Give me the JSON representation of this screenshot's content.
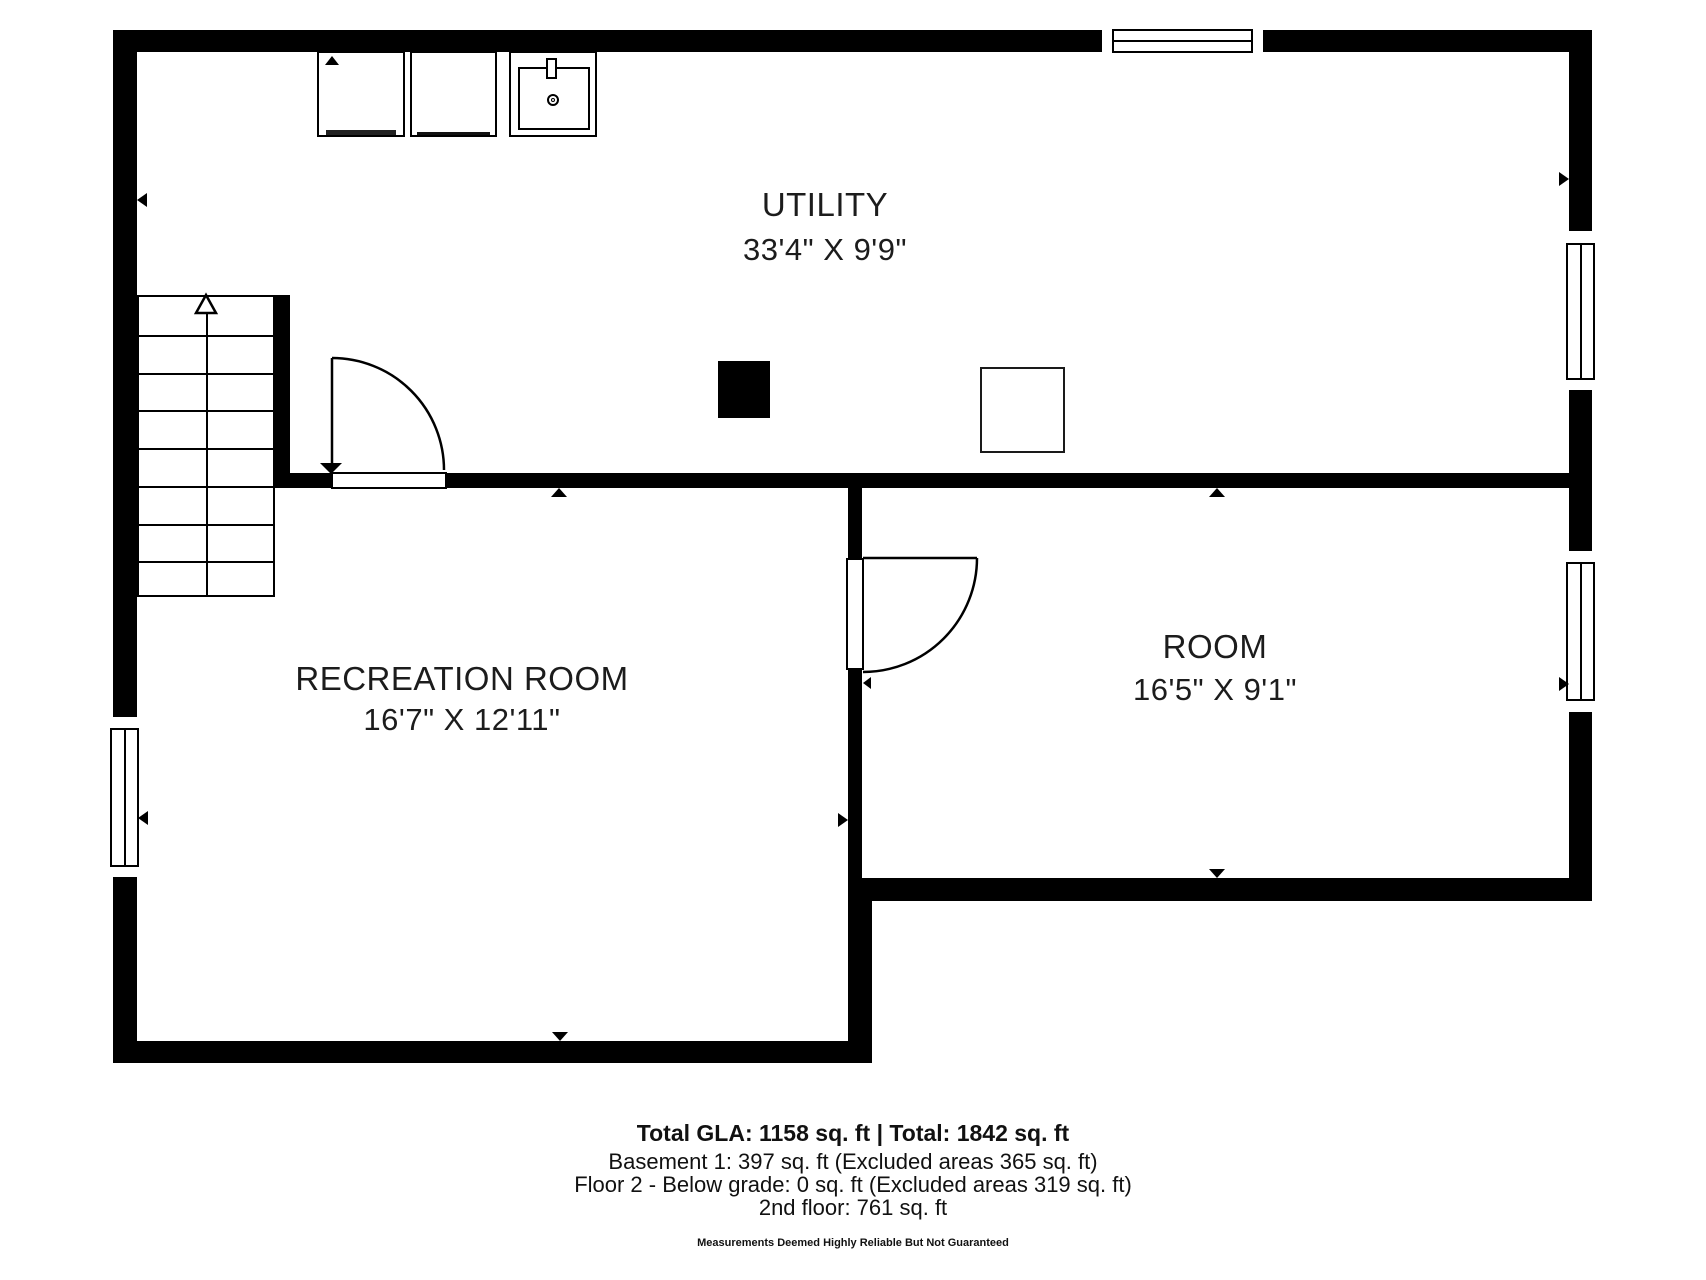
{
  "floorplan": {
    "rooms": [
      {
        "name": "UTILITY",
        "dimensions": "33'4\" X 9'9\""
      },
      {
        "name": "RECREATION ROOM",
        "dimensions": "16'7\" X 12'11\""
      },
      {
        "name": "ROOM",
        "dimensions": "16'5\" X 9'1\""
      }
    ],
    "fixtures": [
      "washer-icon",
      "dryer-icon",
      "laundry-sink-icon",
      "furnace-icon",
      "equipment-pad-icon",
      "staircase-up-icon",
      "door-swing-icon",
      "window-icon"
    ],
    "colors": {
      "wall": "#000000",
      "text": "#1c1c1c",
      "background": "#ffffff"
    }
  },
  "footer": {
    "line1": "Total GLA: 1158 sq. ft | Total: 1842 sq. ft",
    "line2": "Basement 1: 397 sq. ft (Excluded areas 365 sq. ft)",
    "line3": "Floor 2 - Below grade: 0 sq. ft (Excluded areas 319 sq. ft)",
    "line4": "2nd floor: 761 sq. ft",
    "disclaimer": "Measurements Deemed Highly Reliable But Not Guaranteed"
  }
}
